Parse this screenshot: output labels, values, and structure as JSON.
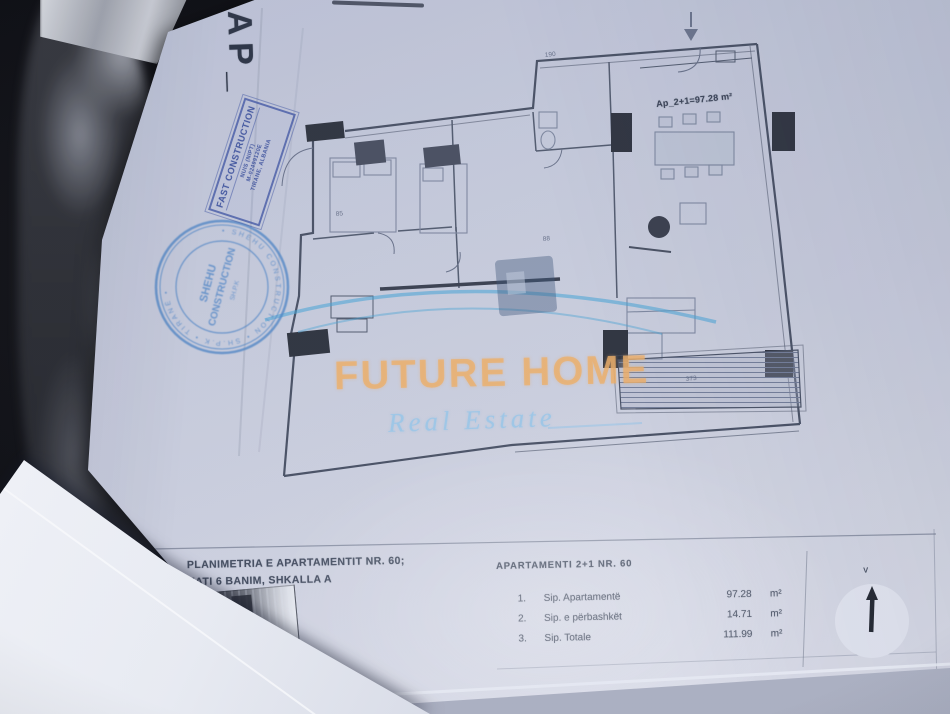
{
  "photo": {
    "background_color": "#0a0a0d",
    "paper_color": "#ccd0de",
    "corner_label": "AP_"
  },
  "stamps": {
    "rect": {
      "color": "#3f58a8",
      "line1": "FAST CONSTRUCTION",
      "line2": "NUIS (NIPT)",
      "line3": "M-02499120E",
      "line4": "TIRANE, ALBANIA"
    },
    "round": {
      "color": "#4f86c6",
      "ring_text": "• SHEHU CONSTRUCTION •  SH.P.K  •  TIRANË  •",
      "center_line1": "SHEHU",
      "center_line2": "CONSTRUCTION",
      "center_line3": "SH.P.K"
    }
  },
  "plan": {
    "area_label": "Ap_2+1=97.28 m²",
    "dims": {
      "d1": "85",
      "d2": "88",
      "d3": "190",
      "d4": "373"
    }
  },
  "watermark": {
    "brand": "FUTURE HOME",
    "tagline": "Real Estate",
    "brand_color": "#f2b268",
    "tagline_color": "#9ecae8",
    "roof_color": "#46a5d7"
  },
  "footer": {
    "title_line1": "PLANIMETRIA E APARTAMENTIT NR. 60;",
    "title_line2": "KATI 6 BANIM, SHKALLA A",
    "table_header": "APARTAMENTI  2+1  NR. 60",
    "rows": [
      {
        "num": "1.",
        "label": "Sip. Apartamentë",
        "value": "97.28",
        "unit": "m²"
      },
      {
        "num": "2.",
        "label": "Sip. e përbashkët",
        "value": "14.71",
        "unit": "m²"
      },
      {
        "num": "3.",
        "label": "Sip. Totale",
        "value": "111.99",
        "unit": "m²"
      }
    ],
    "compass_label": "V"
  }
}
